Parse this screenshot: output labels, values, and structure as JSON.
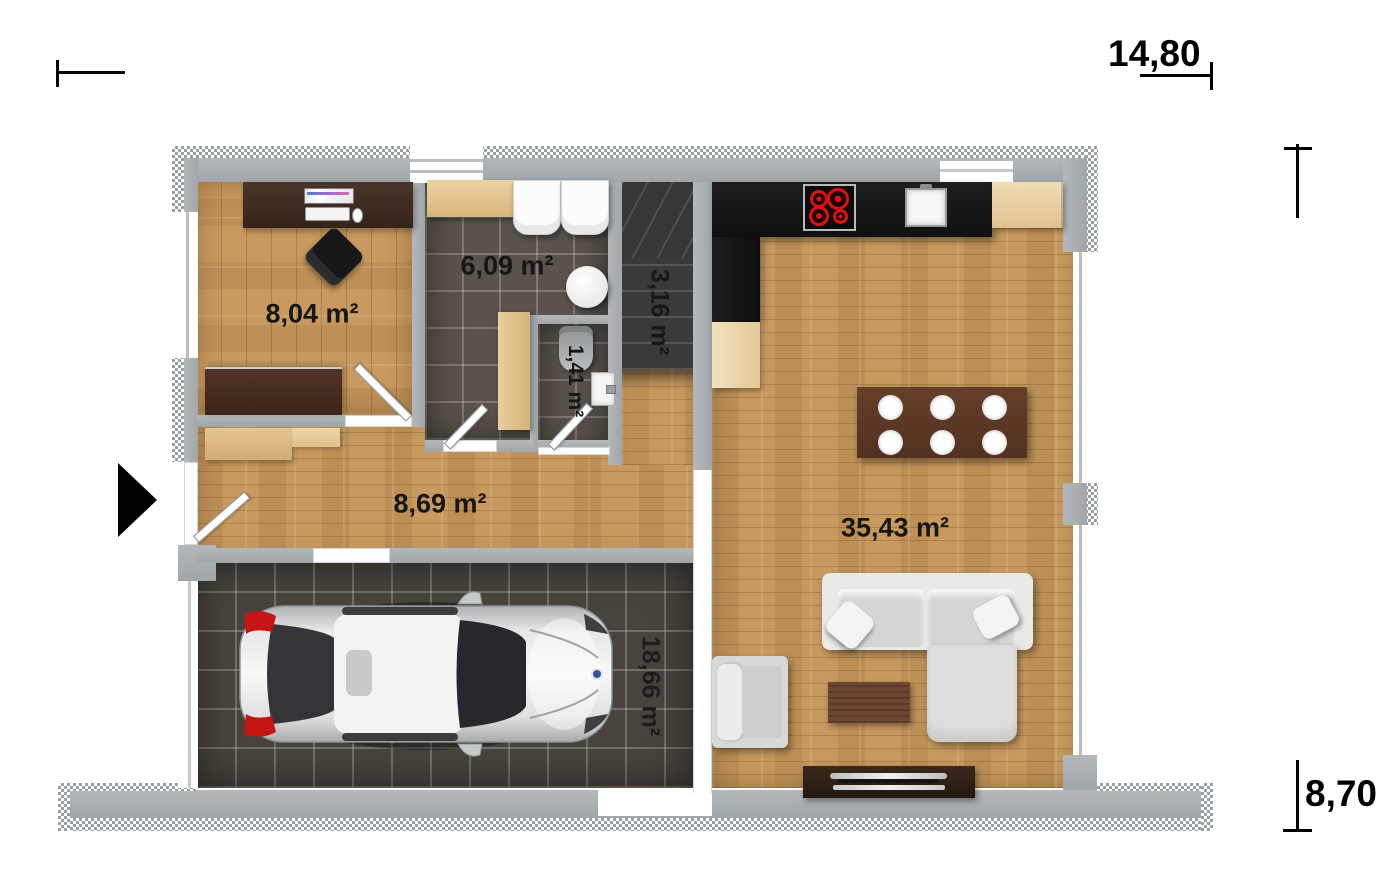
{
  "palette": {
    "wall_gray": "#a9aeb1",
    "wood_floor": "#c89a5f",
    "dark_tile": "#5a534c",
    "garage_tile": "#49433d",
    "kitchen_counter_black": "#161616",
    "label_text": "#161616",
    "burner_red": "#e01010",
    "taillight_red": "#c41414"
  },
  "dimensions": {
    "width_label": "14,80",
    "height_label": "8,70"
  },
  "rooms": {
    "office": {
      "area_label": "8,04 m²"
    },
    "bathroom": {
      "area_label": "6,09 m²"
    },
    "wc": {
      "area_label": "1,41 m²"
    },
    "staircase": {
      "area_label": "3,16 m²"
    },
    "hallway": {
      "area_label": "8,69 m²"
    },
    "living_kitchen": {
      "area_label": "35,43 m²"
    },
    "garage": {
      "area_label": "18,66 m²"
    }
  }
}
